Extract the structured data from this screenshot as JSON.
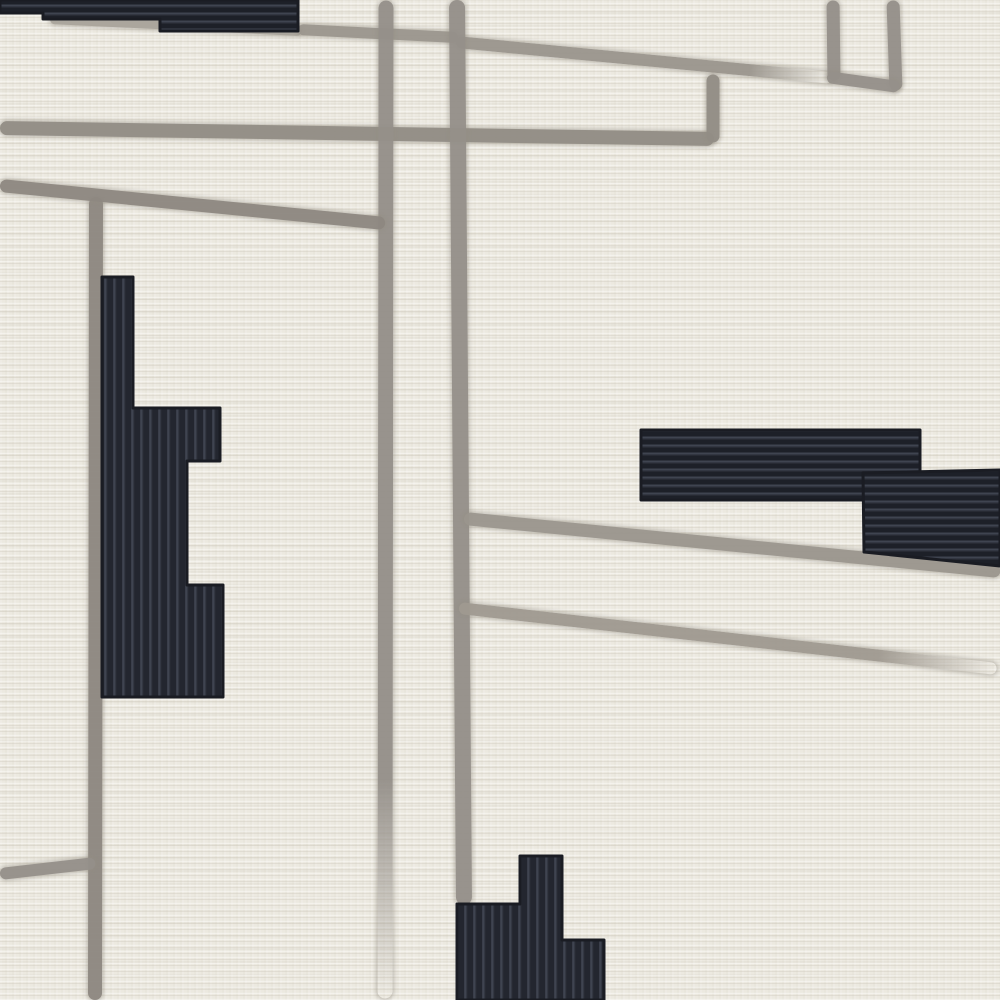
{
  "scene": {
    "subject": "rug-closeup-photo",
    "colors": {
      "background": "#e9e6dd",
      "line_gray": "#95908a",
      "line_gray_light": "#a9a49b",
      "line_gray_dark": "#8e8881",
      "dark_base": "#1d2028",
      "dark_mid": "#272a33",
      "rib_highlight": "#3f4450",
      "rib_vertical_base": "#23262f",
      "dark_edge": "#1a1c23"
    },
    "lines": [
      {
        "name": "under-band-line",
        "x1": 50,
        "y1": 19,
        "x2": 302,
        "y2": 31,
        "th": 10,
        "color": "#a9a49b"
      },
      {
        "name": "top-connector-line",
        "x1": 298,
        "y1": 29,
        "x2": 458,
        "y2": 37,
        "th": 11,
        "color": "#9b968e"
      },
      {
        "name": "top-diagonal-line",
        "x1": 456,
        "y1": 42,
        "x2": 832,
        "y2": 78,
        "th": 12,
        "color": "#9b968e",
        "fade": "end"
      },
      {
        "name": "long-horizontal-line",
        "x1": 0,
        "y1": 128,
        "x2": 714,
        "y2": 139,
        "th": 14,
        "color": "#928d85"
      },
      {
        "name": "right-stub-vertical",
        "x1": 713,
        "y1": 74,
        "x2": 713,
        "y2": 142,
        "th": 13,
        "color": "#928d85"
      },
      {
        "name": "topright-vertical-1",
        "x1": 833,
        "y1": 0,
        "x2": 834,
        "y2": 80,
        "th": 13,
        "color": "#95908a"
      },
      {
        "name": "topright-vertical-2",
        "x1": 893,
        "y1": 0,
        "x2": 896,
        "y2": 90,
        "th": 13,
        "color": "#95908a"
      },
      {
        "name": "topright-connector",
        "x1": 827,
        "y1": 77,
        "x2": 899,
        "y2": 87,
        "th": 12,
        "color": "#95908a"
      },
      {
        "name": "center-vertical-1",
        "x1": 386,
        "y1": 0,
        "x2": 385,
        "y2": 998,
        "th": 15,
        "color": "#95908a",
        "fade": "end"
      },
      {
        "name": "center-vertical-2",
        "x1": 457,
        "y1": 0,
        "x2": 464,
        "y2": 905,
        "th": 16,
        "color": "#95908a"
      },
      {
        "name": "left-vertical",
        "x1": 96,
        "y1": 197,
        "x2": 95,
        "y2": 1000,
        "th": 14,
        "color": "#8e8881"
      },
      {
        "name": "left-horizontal-branch",
        "x1": 0,
        "y1": 185,
        "x2": 385,
        "y2": 223,
        "th": 13,
        "color": "#8e8881"
      },
      {
        "name": "right-branch-upper",
        "x1": 464,
        "y1": 518,
        "x2": 1000,
        "y2": 571,
        "th": 13,
        "color": "#9b968e"
      },
      {
        "name": "right-branch-lower",
        "x1": 459,
        "y1": 608,
        "x2": 997,
        "y2": 669,
        "th": 12,
        "color": "#a09a91",
        "fade": "end"
      },
      {
        "name": "bottomleft-branch",
        "x1": 0,
        "y1": 874,
        "x2": 95,
        "y2": 863,
        "th": 12,
        "color": "#95908a"
      }
    ],
    "dark_shapes": [
      {
        "name": "top-left-band",
        "ribs": "ribsH",
        "points": [
          [
            0,
            0
          ],
          [
            298,
            0
          ],
          [
            298,
            31
          ],
          [
            160,
            31
          ],
          [
            160,
            19
          ],
          [
            43,
            19
          ],
          [
            43,
            13
          ],
          [
            0,
            13
          ]
        ]
      },
      {
        "name": "left-stepped-block",
        "ribs": "ribsV",
        "points": [
          [
            102,
            277
          ],
          [
            133,
            277
          ],
          [
            133,
            408
          ],
          [
            220,
            408
          ],
          [
            220,
            461
          ],
          [
            187,
            461
          ],
          [
            187,
            585
          ],
          [
            223,
            585
          ],
          [
            223,
            697
          ],
          [
            102,
            697
          ]
        ]
      },
      {
        "name": "right-bar-upper",
        "ribs": "ribsH",
        "points": [
          [
            641,
            430
          ],
          [
            920,
            430
          ],
          [
            920,
            500
          ],
          [
            641,
            500
          ]
        ]
      },
      {
        "name": "right-bar-lower",
        "ribs": "ribsH",
        "points": [
          [
            863,
            473
          ],
          [
            1000,
            470
          ],
          [
            1000,
            566
          ],
          [
            864,
            552
          ]
        ]
      },
      {
        "name": "bottom-stepped-block",
        "ribs": "ribsV",
        "points": [
          [
            520,
            856
          ],
          [
            562,
            856
          ],
          [
            562,
            940
          ],
          [
            604,
            940
          ],
          [
            604,
            1000
          ],
          [
            457,
            1000
          ],
          [
            457,
            904
          ],
          [
            520,
            904
          ]
        ]
      }
    ]
  }
}
